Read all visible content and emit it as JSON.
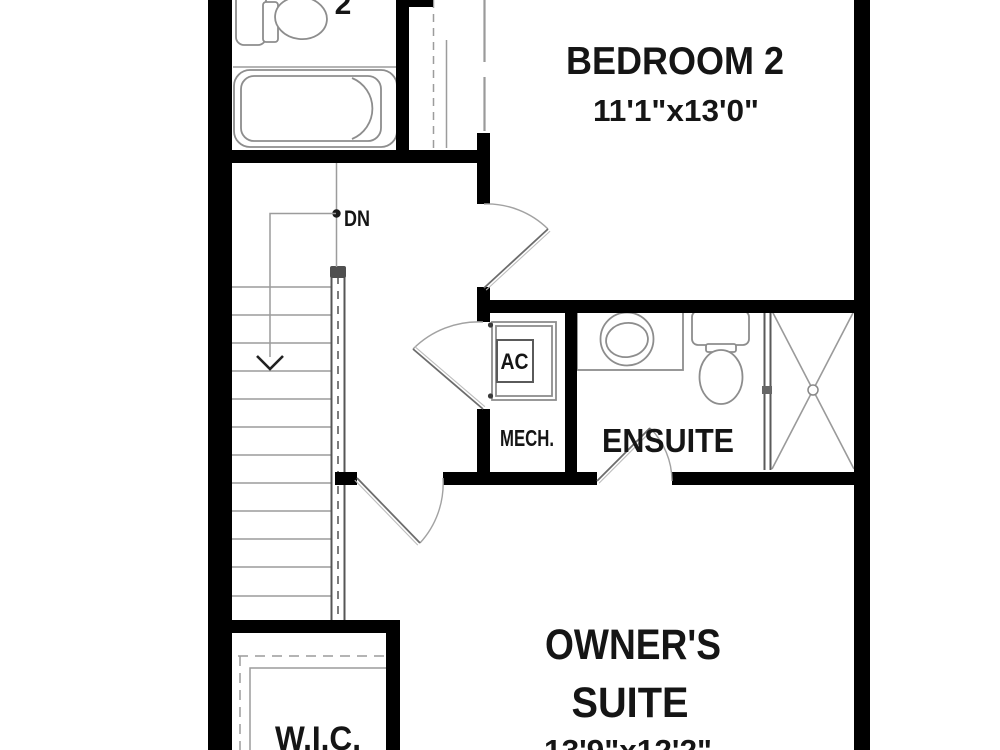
{
  "rooms": {
    "bath2": {
      "label_partial": "2"
    },
    "bedroom2": {
      "label": "BEDROOM 2",
      "dims": "11'1\"x13'0\""
    },
    "ensuite": {
      "label": "ENSUITE"
    },
    "mech": {
      "label": "MECH.",
      "ac_label": "AC"
    },
    "owners_suite": {
      "label_line1": "OWNER'S",
      "label_line2": "SUITE",
      "dims": "13'9\"x12'2\""
    },
    "wic": {
      "label": "W.I.C."
    },
    "stairs": {
      "down_label": "DN"
    }
  },
  "colors": {
    "background": "#ffffff",
    "wall": "#000000",
    "fixture": "#8d8d8d",
    "stair": "#9c9c9c",
    "rail": "#565656",
    "door": "#a2a2a2",
    "text": "#151515"
  }
}
